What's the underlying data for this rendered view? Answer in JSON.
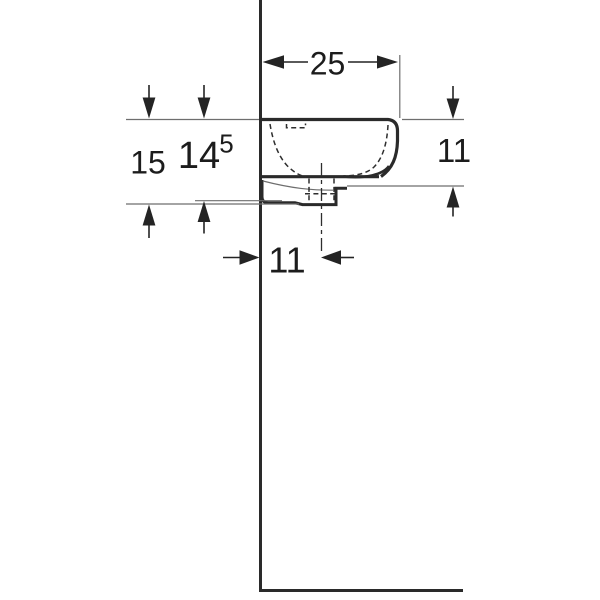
{
  "diagram": {
    "type": "technical-dimension-drawing",
    "subject": "wall-hung washbasin side profile",
    "background": "#ffffff",
    "line_color": "#2a2a2a",
    "thin_line_color": "#6e6e6e",
    "text_color": "#1c1c1c",
    "dimensions": {
      "width_top": {
        "label": "25",
        "orientation": "horizontal",
        "position": "top",
        "measures": "wall to basin front edge"
      },
      "height_left_outer": {
        "label": "15",
        "orientation": "vertical",
        "position": "left",
        "measures": "rim top to lowest point"
      },
      "height_left_inner": {
        "label": "14",
        "superscript": "5",
        "orientation": "vertical",
        "position": "left",
        "measures": "rim top to underside at wall"
      },
      "height_right": {
        "label": "11",
        "orientation": "vertical",
        "position": "right",
        "measures": "rim top to basin underside front"
      },
      "offset_bottom": {
        "label": "11",
        "orientation": "horizontal",
        "position": "bottom",
        "measures": "wall to drain centerline"
      }
    }
  }
}
